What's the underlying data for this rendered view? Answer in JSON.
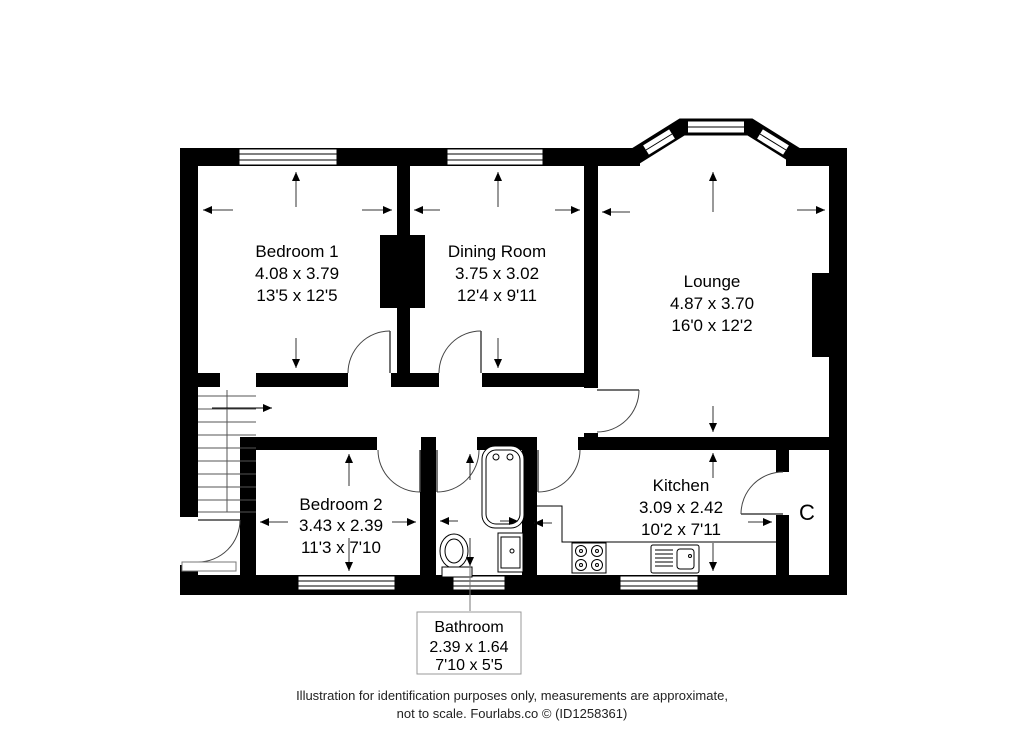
{
  "floorplan": {
    "rooms": [
      {
        "name": "Bedroom 1",
        "metric": "4.08 x 3.79",
        "imperial": "13'5 x 12'5"
      },
      {
        "name": "Dining Room",
        "metric": "3.75 x 3.02",
        "imperial": "12'4 x 9'11"
      },
      {
        "name": "Lounge",
        "metric": "4.87 x 3.70",
        "imperial": "16'0 x 12'2"
      },
      {
        "name": "Bedroom 2",
        "metric": "3.43 x 2.39",
        "imperial": "11'3 x 7'10"
      },
      {
        "name": "Kitchen",
        "metric": "3.09 x 2.42",
        "imperial": "10'2 x 7'11"
      },
      {
        "name": "Bathroom",
        "metric": "2.39 x 1.64",
        "imperial": "7'10 x 5'5"
      }
    ],
    "cupboard": {
      "label": "C"
    },
    "footer": {
      "line1": "Illustration for identification purposes only, measurements are approximate,",
      "line2": "not to scale. Fourlabs.co © (ID1258361)"
    },
    "colors": {
      "wall": "#000000",
      "background": "#ffffff",
      "thin_line": "#444444"
    }
  }
}
